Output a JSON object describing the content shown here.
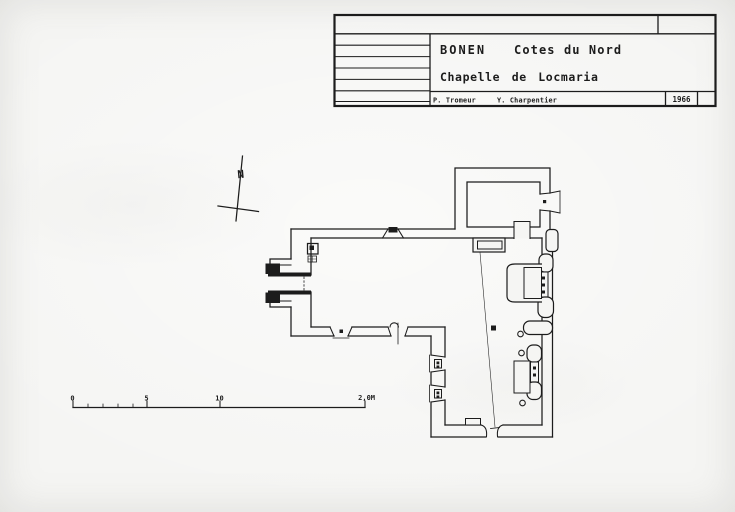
{
  "colors": {
    "ink": "#1c1c1c",
    "paper": "#f5f5f3"
  },
  "title_block": {
    "commune": "BONEN",
    "department": "Cotes du Nord",
    "monument": "Chapelle de Locmaria",
    "author_1": "P. Tromeur",
    "author_2": "Y. Charpentier",
    "year": "1966"
  },
  "north_arrow": {
    "label": "N"
  },
  "scale_bar": {
    "labels": [
      "0",
      "5",
      "10",
      "2,0M"
    ]
  }
}
